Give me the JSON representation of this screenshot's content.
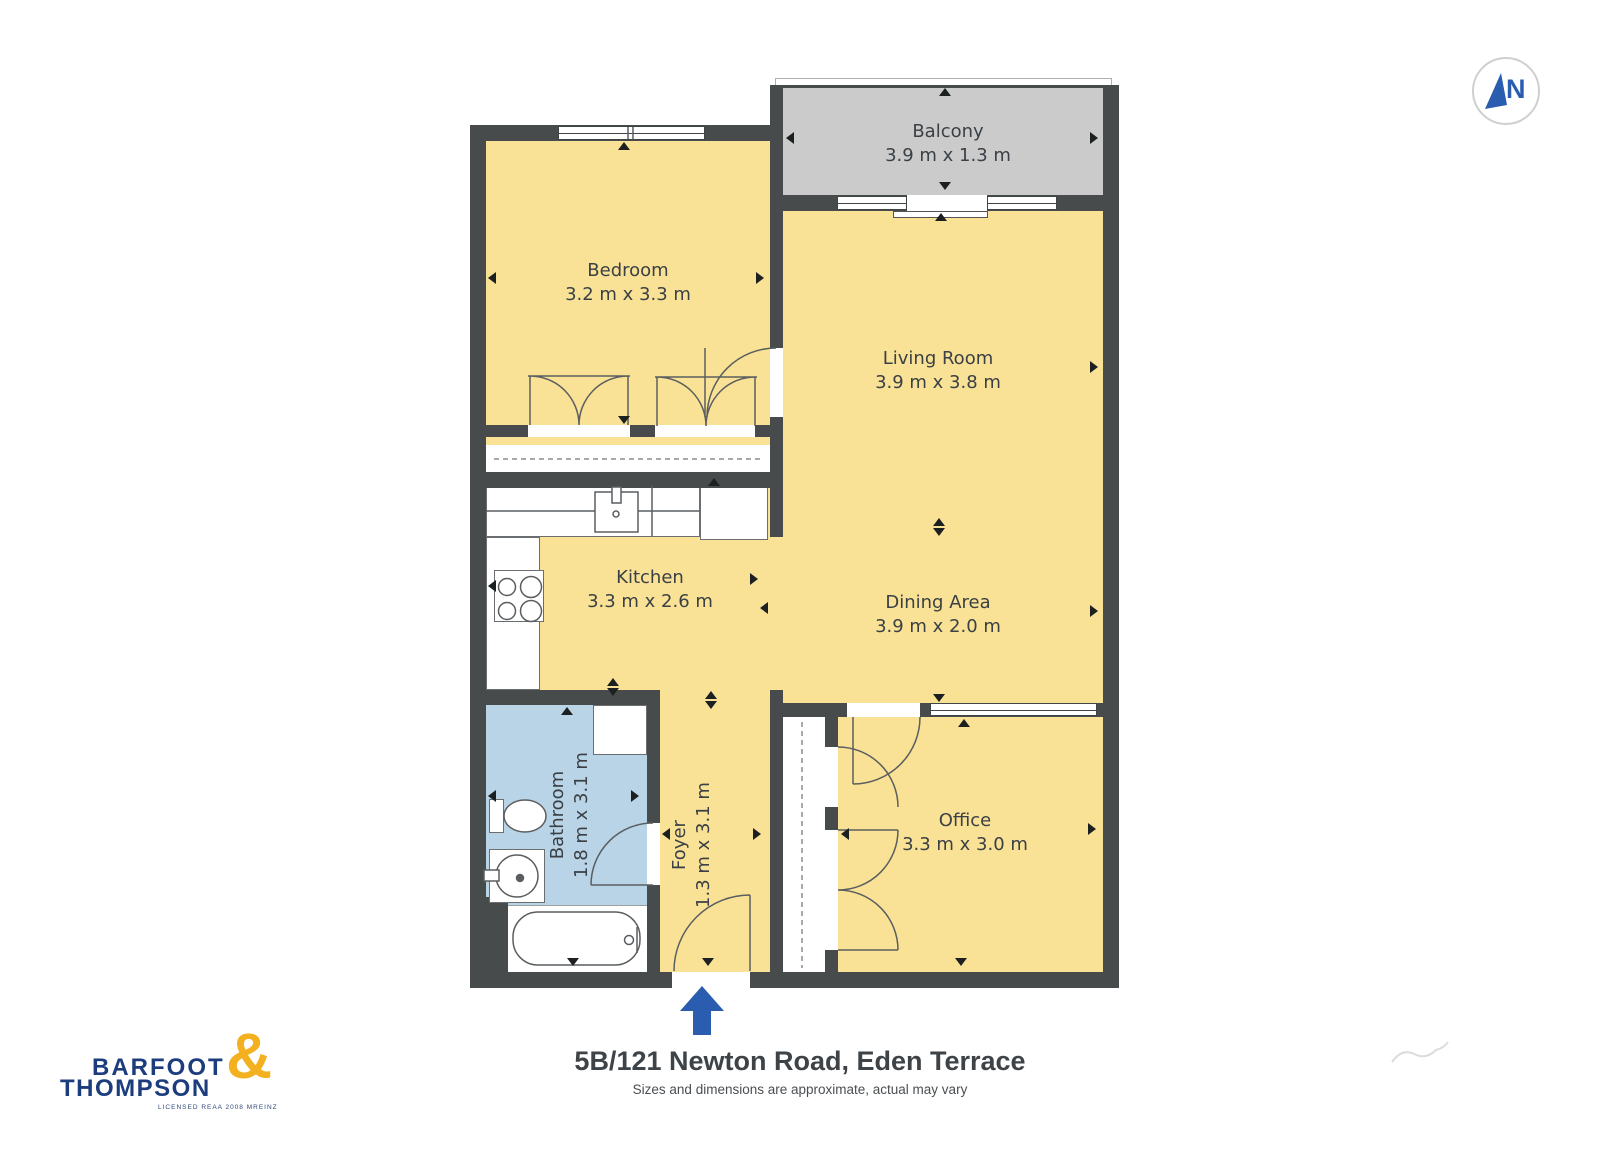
{
  "plan_type": "floor-plan",
  "compass": {
    "label": "N"
  },
  "rooms": [
    {
      "id": "balcony",
      "name": "Balcony",
      "dims": "3.9 m x 1.3 m"
    },
    {
      "id": "bedroom",
      "name": "Bedroom",
      "dims": "3.2 m x 3.3 m"
    },
    {
      "id": "living",
      "name": "Living Room",
      "dims": "3.9 m x 3.8 m"
    },
    {
      "id": "kitchen",
      "name": "Kitchen",
      "dims": "3.3 m x 2.6 m"
    },
    {
      "id": "dining",
      "name": "Dining Area",
      "dims": "3.9 m x 2.0 m"
    },
    {
      "id": "bathroom",
      "name": "Bathroom",
      "dims": "1.8 m x 3.1 m"
    },
    {
      "id": "foyer",
      "name": "Foyer",
      "dims": "1.3 m x 3.1 m"
    },
    {
      "id": "office",
      "name": "Office",
      "dims": "3.3 m x 3.0 m"
    }
  ],
  "footer": {
    "title": "5B/121 Newton Road, Eden Terrace",
    "disclaimer": "Sizes and dimensions are approximate, actual may vary"
  },
  "logo": {
    "word1": "BARFOOT",
    "word2": "THOMPSON",
    "ampersand": "&",
    "license": "LICENSED REAA 2008 MREINZ"
  },
  "colors": {
    "wall": "#474B4C",
    "floor": "#F9E295",
    "bathroom_floor": "#B8D4E6",
    "balcony_floor": "#CBCBCB",
    "entry_arrow": "#2A5DAF",
    "compass_blue": "#2A5DAF",
    "logo_navy": "#1C3D7D",
    "logo_gold": "#F3B01F",
    "label_text": "#3A4045"
  }
}
